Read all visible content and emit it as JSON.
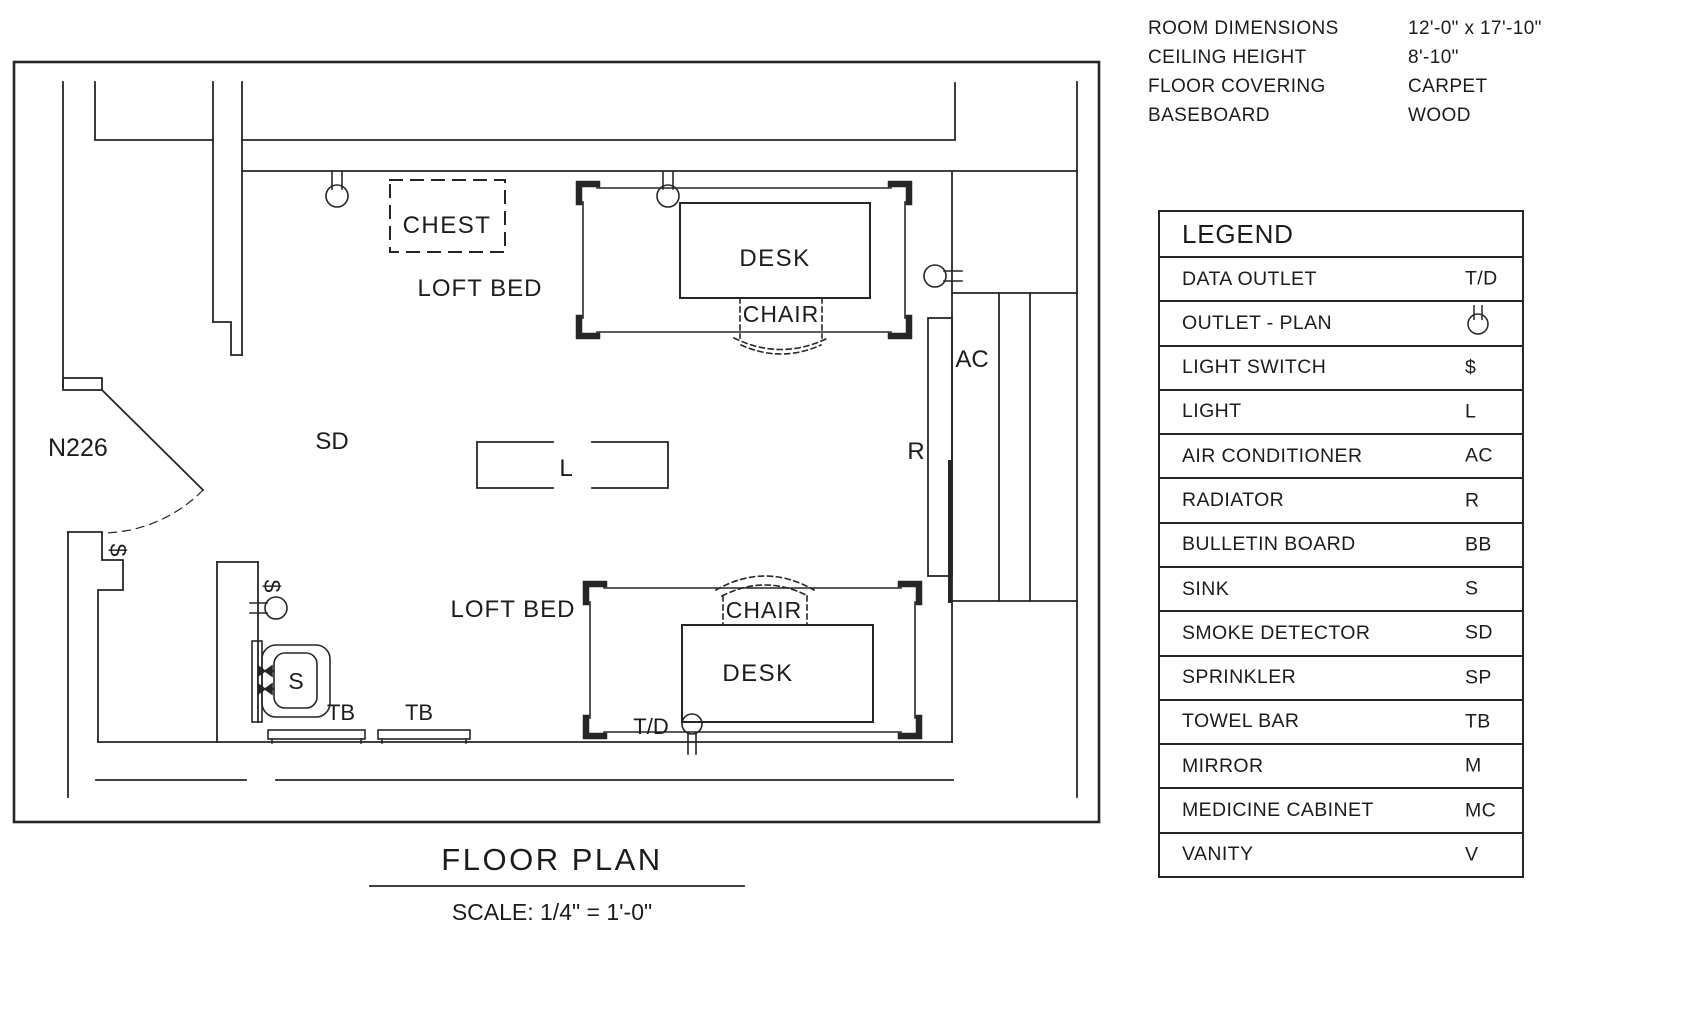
{
  "room_info": {
    "rows": [
      {
        "label": "ROOM DIMENSIONS",
        "value": "12'-0\" x 17'-10\""
      },
      {
        "label": "CEILING HEIGHT",
        "value": "8'-10\""
      },
      {
        "label": "FLOOR COVERING",
        "value": "CARPET"
      },
      {
        "label": "BASEBOARD",
        "value": "WOOD"
      }
    ]
  },
  "legend": {
    "title": "LEGEND",
    "rows": [
      {
        "label": "DATA OUTLET",
        "symbol": "T/D"
      },
      {
        "label": "OUTLET - PLAN",
        "symbol": "",
        "symbol_icon": "duplex-outlet-glyph"
      },
      {
        "label": "LIGHT SWITCH",
        "symbol": "$"
      },
      {
        "label": "LIGHT",
        "symbol": "L"
      },
      {
        "label": "AIR CONDITIONER",
        "symbol": "AC"
      },
      {
        "label": "RADIATOR",
        "symbol": "R"
      },
      {
        "label": "BULLETIN BOARD",
        "symbol": "BB"
      },
      {
        "label": "SINK",
        "symbol": "S"
      },
      {
        "label": "SMOKE DETECTOR",
        "symbol": "SD"
      },
      {
        "label": "SPRINKLER",
        "symbol": "SP"
      },
      {
        "label": "TOWEL BAR",
        "symbol": "TB"
      },
      {
        "label": "MIRROR",
        "symbol": "M"
      },
      {
        "label": "MEDICINE CABINET",
        "symbol": "MC"
      },
      {
        "label": "VANITY",
        "symbol": "V"
      }
    ]
  },
  "plan": {
    "room_number": "N226",
    "title": "FLOOR  PLAN",
    "scale_note": "SCALE: 1/4\" = 1'-0\"",
    "labels": {
      "chest": "CHEST",
      "loft_bed_top": "LOFT BED",
      "desk_top": "DESK",
      "chair_top": "CHAIR",
      "loft_bed_bottom": "LOFT BED",
      "desk_bottom": "DESK",
      "chair_bottom": "CHAIR",
      "smoke_detector": "SD",
      "light": "L",
      "air_conditioner": "AC",
      "radiator": "R",
      "sink": "S",
      "towel_bar_left": "TB",
      "towel_bar_right": "TB",
      "data_outlet": "T/D",
      "light_switch_door": "$",
      "light_switch_bath": "$"
    },
    "colors": {
      "line": "#262626",
      "background": "#ffffff"
    }
  }
}
